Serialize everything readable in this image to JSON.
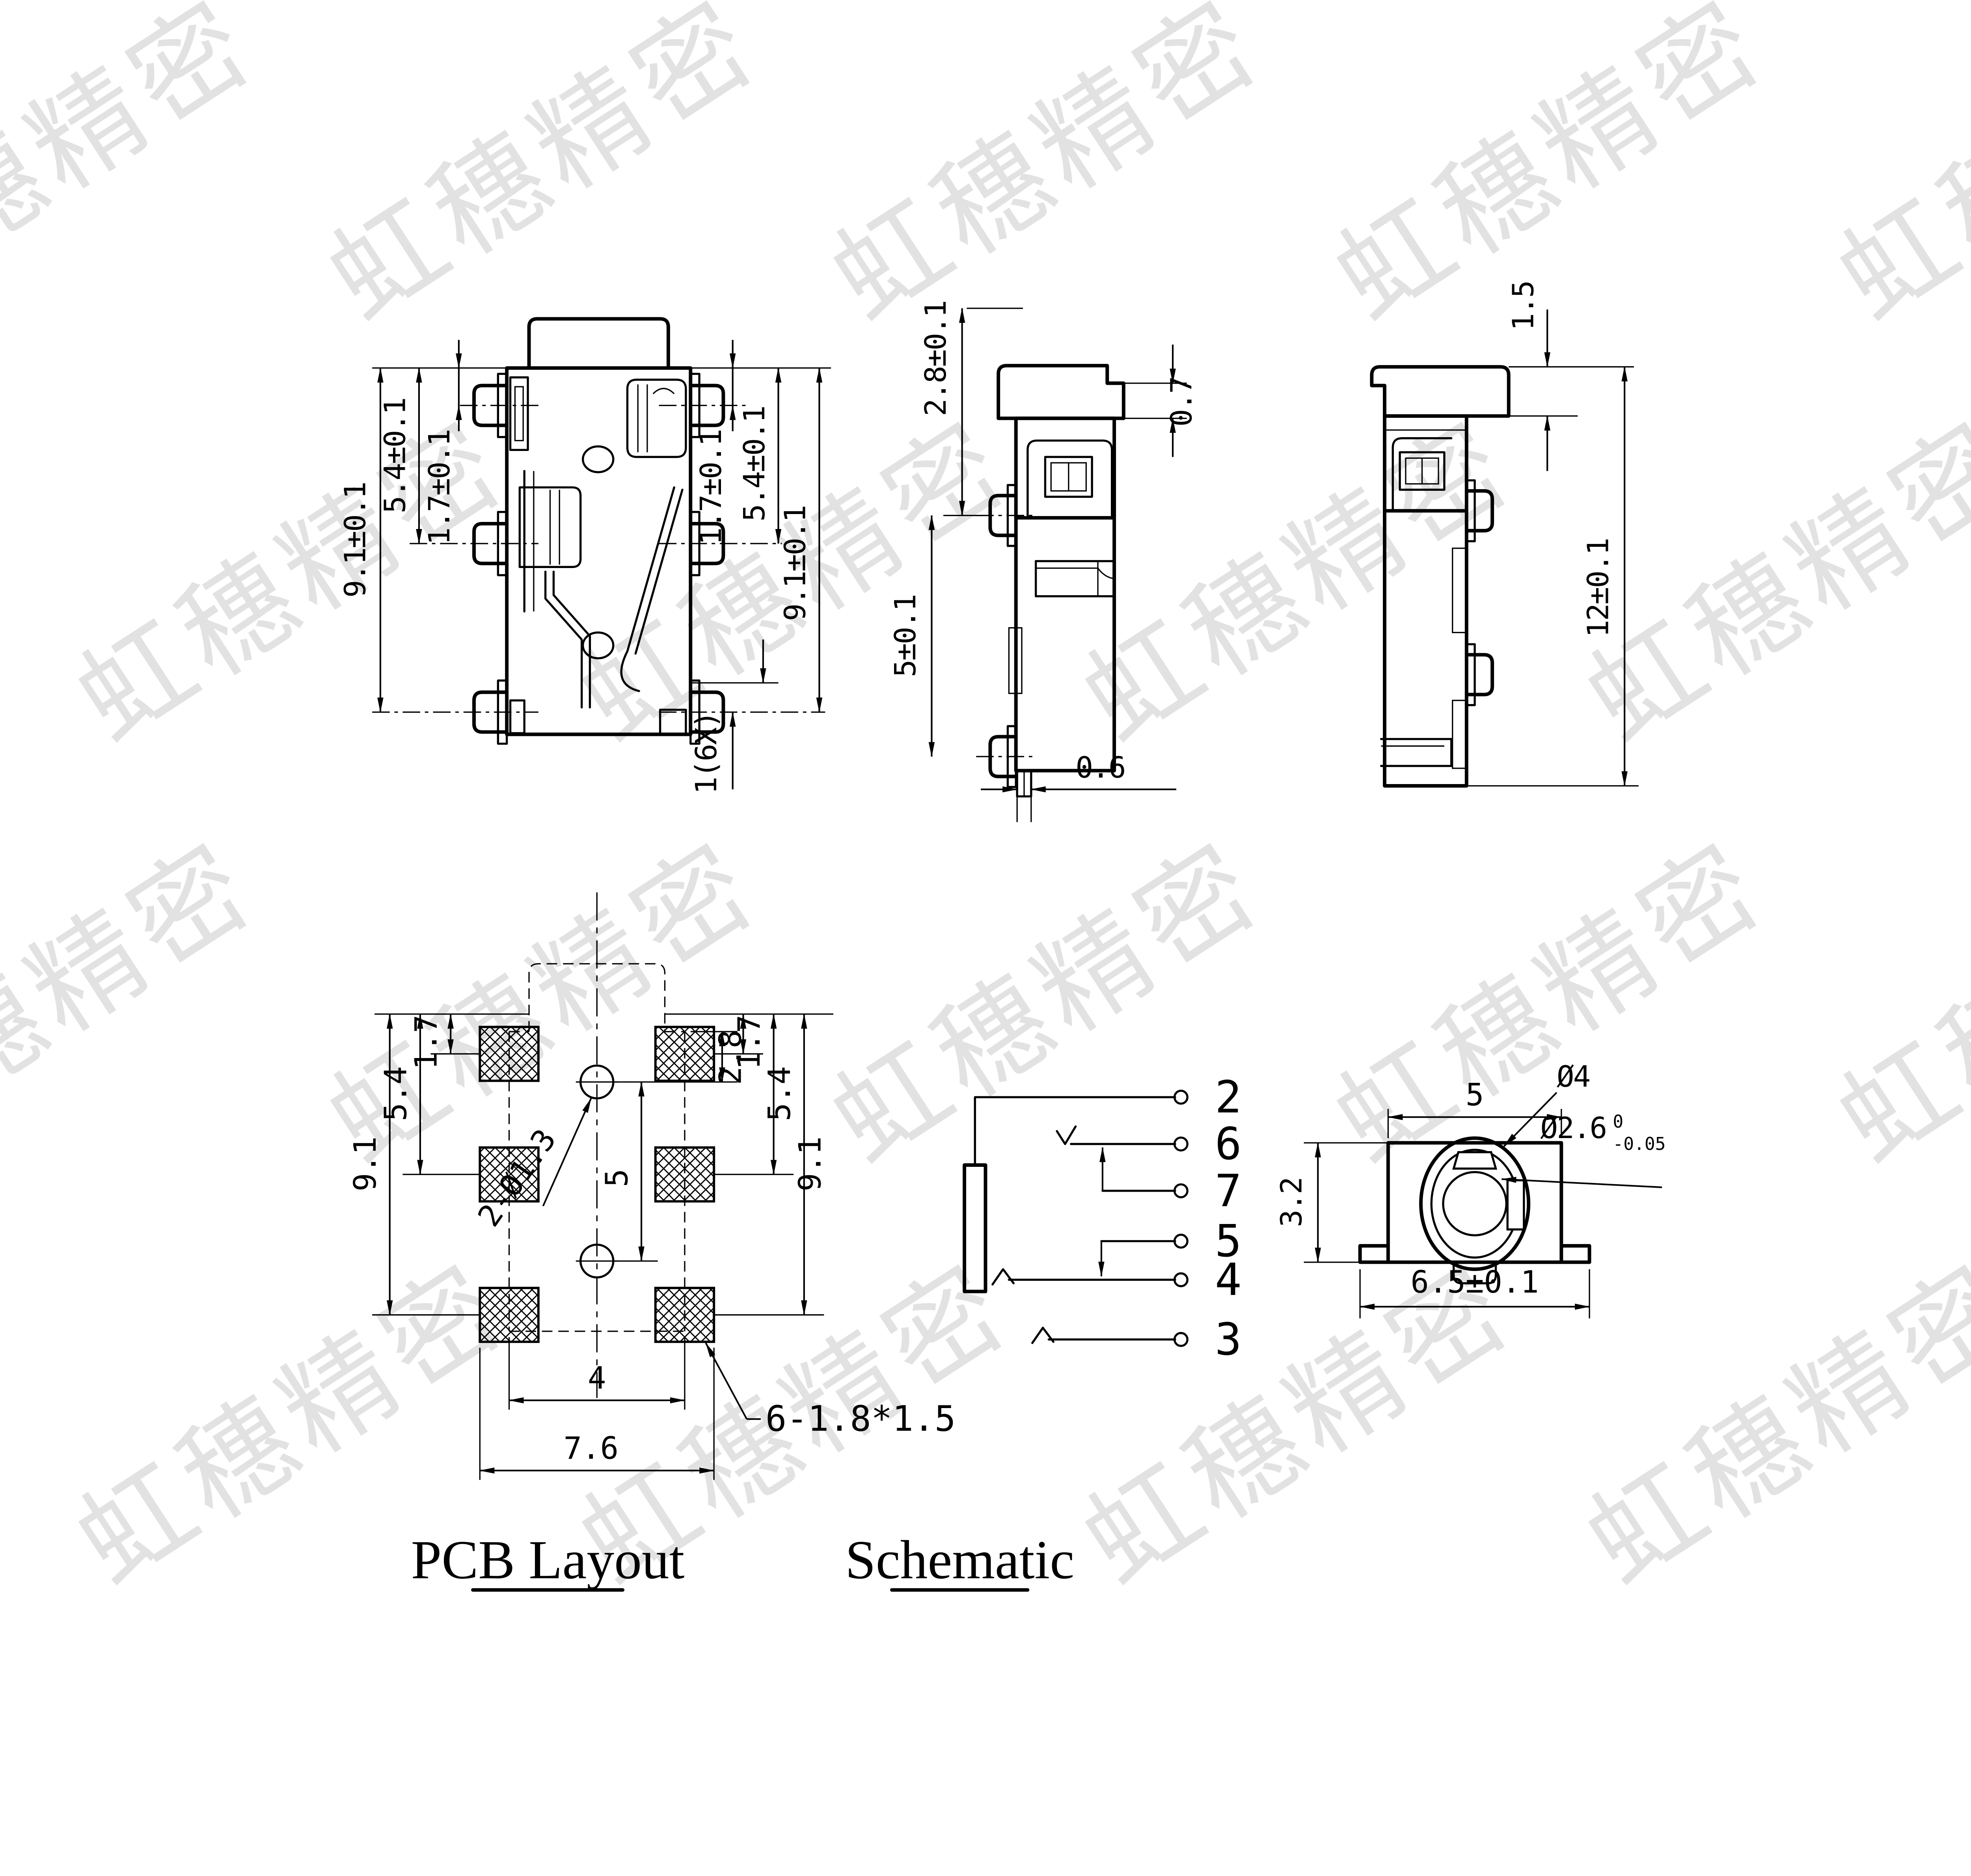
{
  "watermark": {
    "text": "虹穗精密",
    "color": "#e2e2e2"
  },
  "views": {
    "front": {
      "dims": {
        "left_overall": "9.1±0.1",
        "left_mid": "5.4±0.1",
        "left_top": "1.7±0.1",
        "right_top": "1.7±0.1",
        "right_mid": "5.4±0.1",
        "right_overall": "9.1±0.1",
        "pin_note": "1(6X)"
      }
    },
    "side_a": {
      "dims": {
        "cap_height": "2.8±0.1",
        "cap_step": "0.7",
        "pin_pitch": "5±0.1",
        "foot_width": "0.6"
      }
    },
    "side_b": {
      "dims": {
        "cap_height": "1.5",
        "overall_height": "12±0.1"
      }
    },
    "pcb": {
      "label": "PCB Layout",
      "dims": {
        "left_top": "1.7",
        "left_mid": "5.4",
        "left_overall": "9.1",
        "right_top": "1.7",
        "right_mid": "5.4",
        "right_overall": "9.1",
        "hole_offset": "2.8",
        "hole_pitch": "5",
        "pad_pitch": "4",
        "pad_span": "7.6",
        "holes_note": "2-Ø1.3",
        "pads_note": "6-1.8*1.5"
      }
    },
    "schematic": {
      "label": "Schematic",
      "pins": [
        "2",
        "6",
        "7",
        "5",
        "4",
        "3"
      ]
    },
    "face": {
      "dims": {
        "width": "5",
        "height": "3.2",
        "flange_width": "6.5±0.1",
        "outer_dia": "Ø4",
        "inner_dia": "Ø2.6",
        "tol_high": "0",
        "tol_low": "-0.05"
      }
    }
  }
}
